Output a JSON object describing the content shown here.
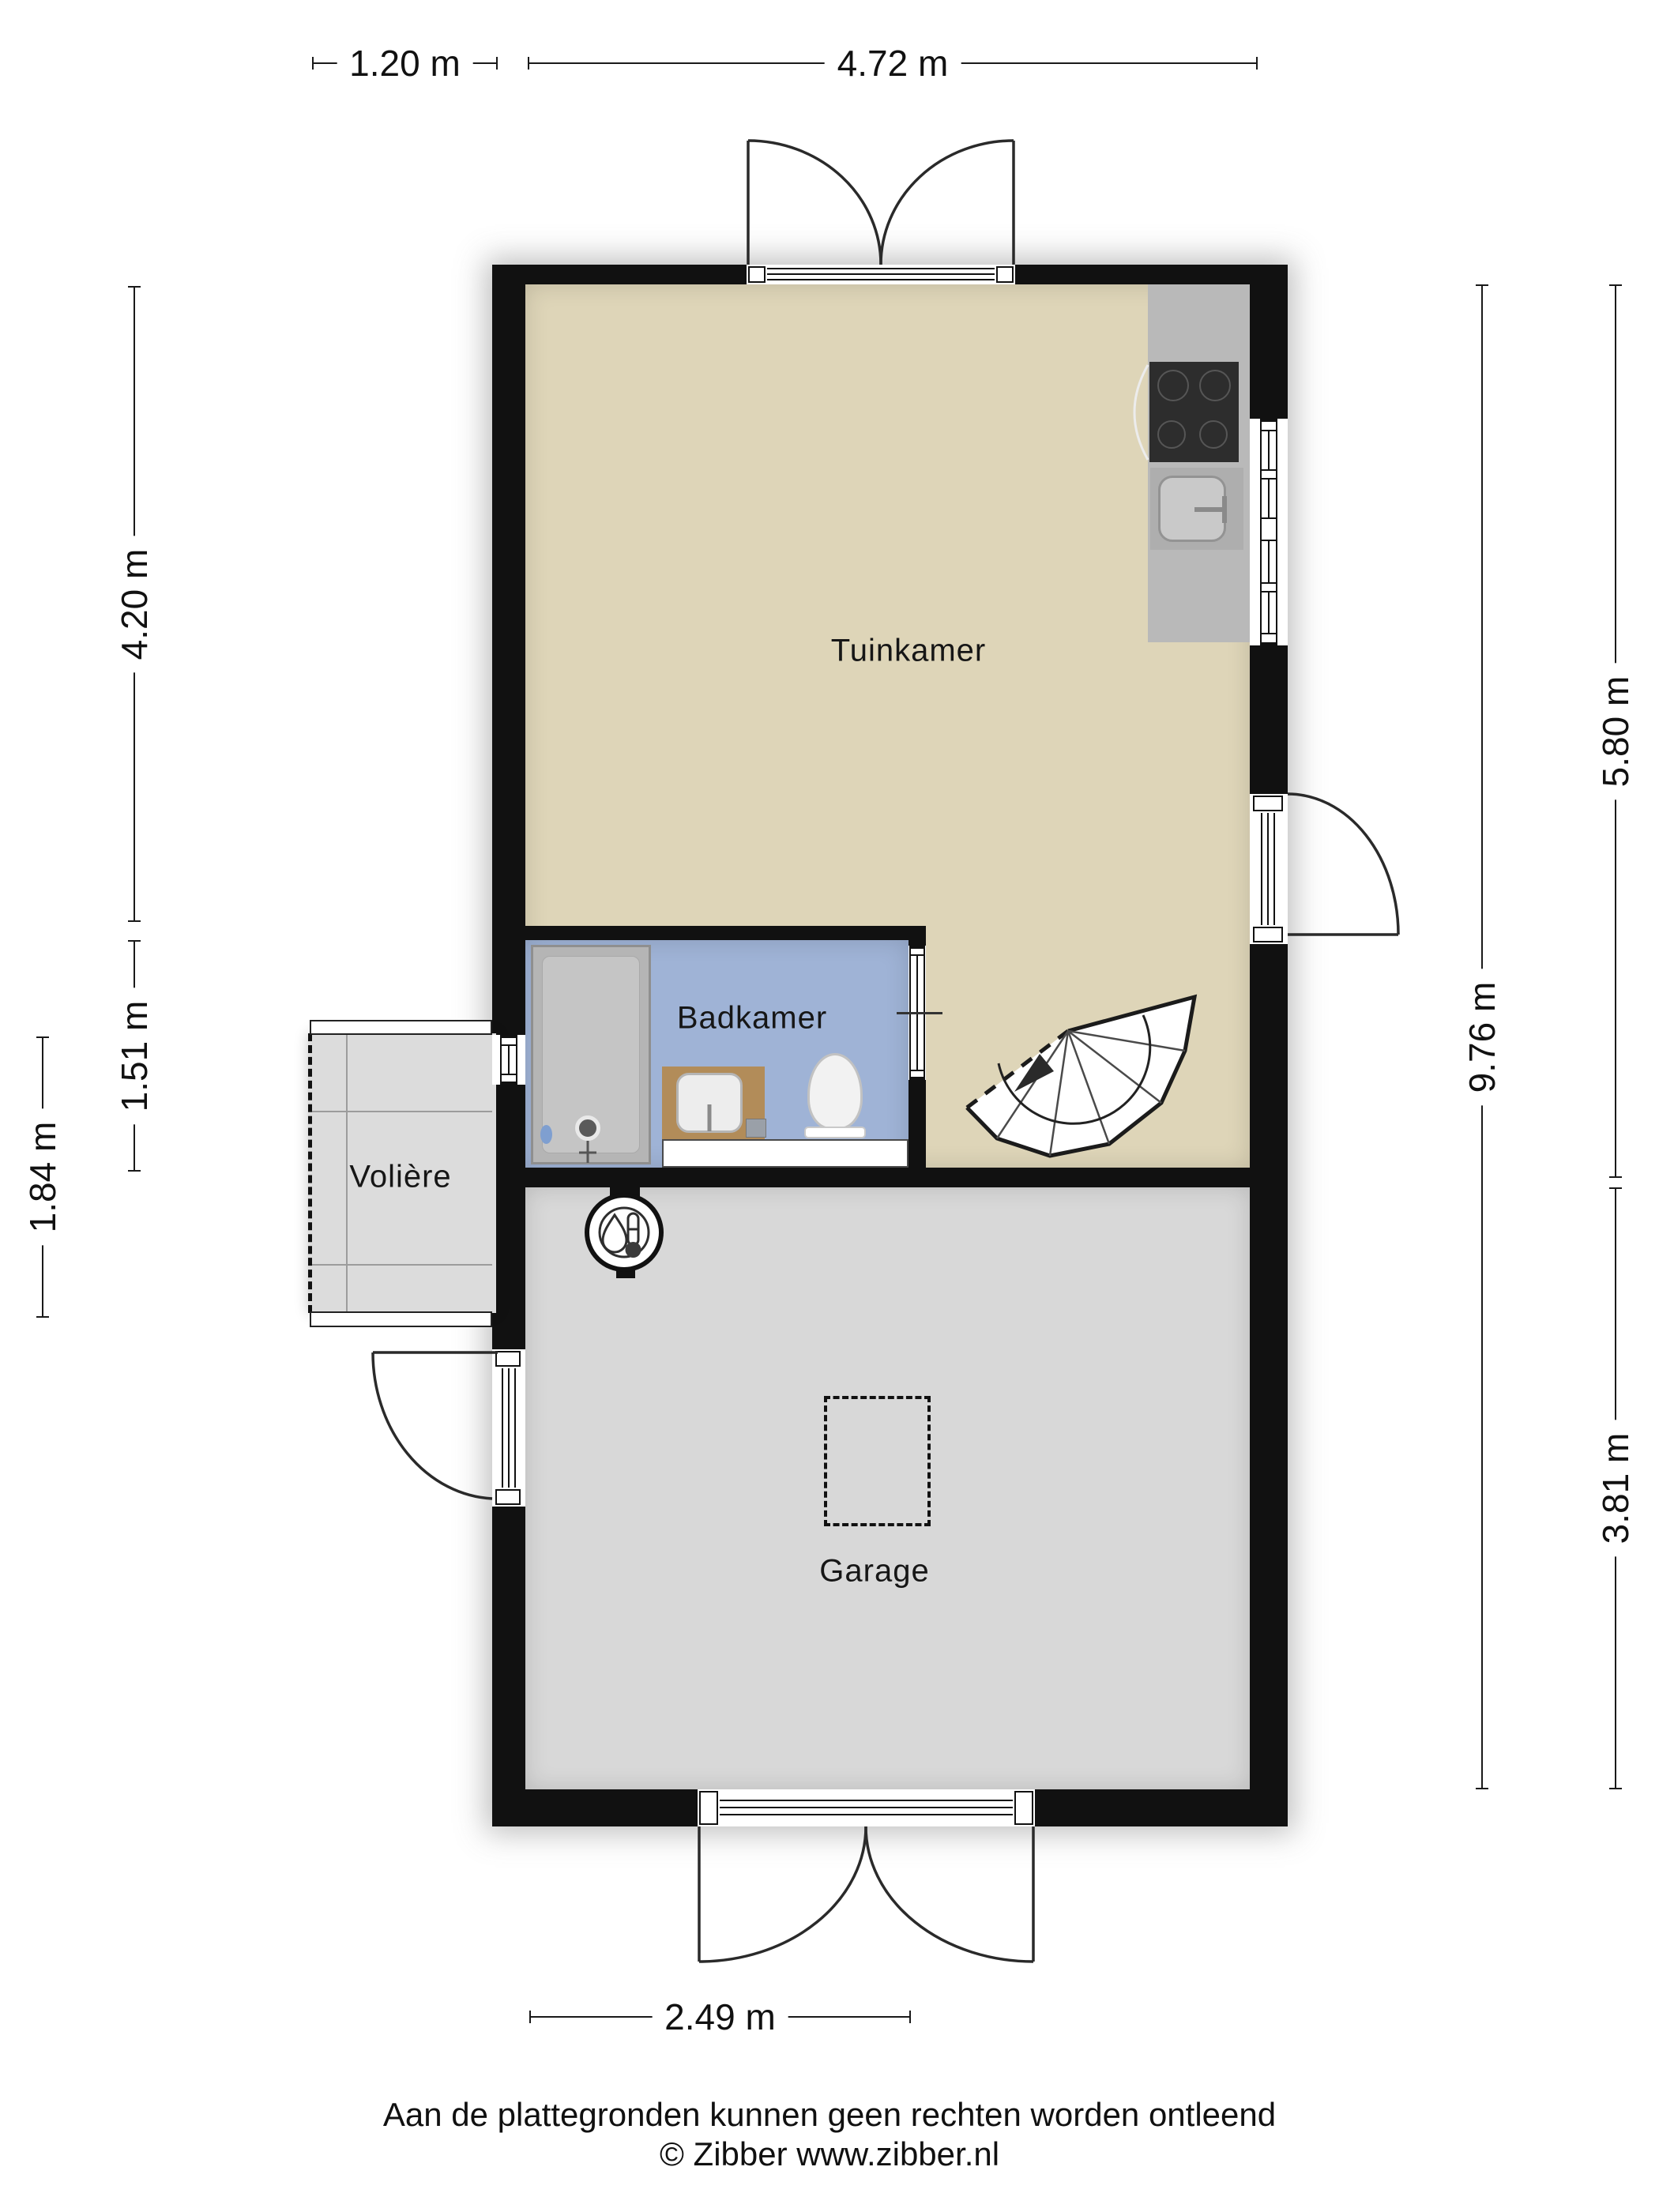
{
  "plan": {
    "rooms": {
      "tuinkamer": "Tuinkamer",
      "badkamer": "Badkamer",
      "voliere": "Volière",
      "garage": "Garage"
    },
    "dimensions": {
      "top_left": "1.20 m",
      "top_right": "4.72 m",
      "left_upper": "4.20 m",
      "left_middle": "1.51 m",
      "left_lower": "1.84 m",
      "right_inner": "9.76 m",
      "right_upper": "5.80 m",
      "right_lower": "3.81 m",
      "bottom": "2.49 m"
    }
  },
  "footer": {
    "disclaimer": "Aan de plattegronden kunnen geen rechten worden ontleend",
    "credit": "© Zibber www.zibber.nl"
  },
  "icons": {
    "staircase": "spiral-staircase-icon",
    "water_heater": "water-heater-icon",
    "cooktop": "cooktop-icon",
    "sink": "kitchen-sink-icon",
    "shower": "shower-icon",
    "toilet": "toilet-icon",
    "washbasin": "washbasin-icon"
  },
  "colors": {
    "wall": "#111111",
    "floor_tuinkamer": "#ded5b8",
    "floor_badkamer": "#9fb3d6",
    "floor_garage": "#d8d8d8",
    "floor_voliere": "#dcdcdc",
    "kitchen_counter": "#b9b9b9",
    "cooktop": "#2d2d2d",
    "shower": "#b5b5b5",
    "vanity_wood": "#b28c59",
    "dim_line": "#1a1a1a"
  }
}
